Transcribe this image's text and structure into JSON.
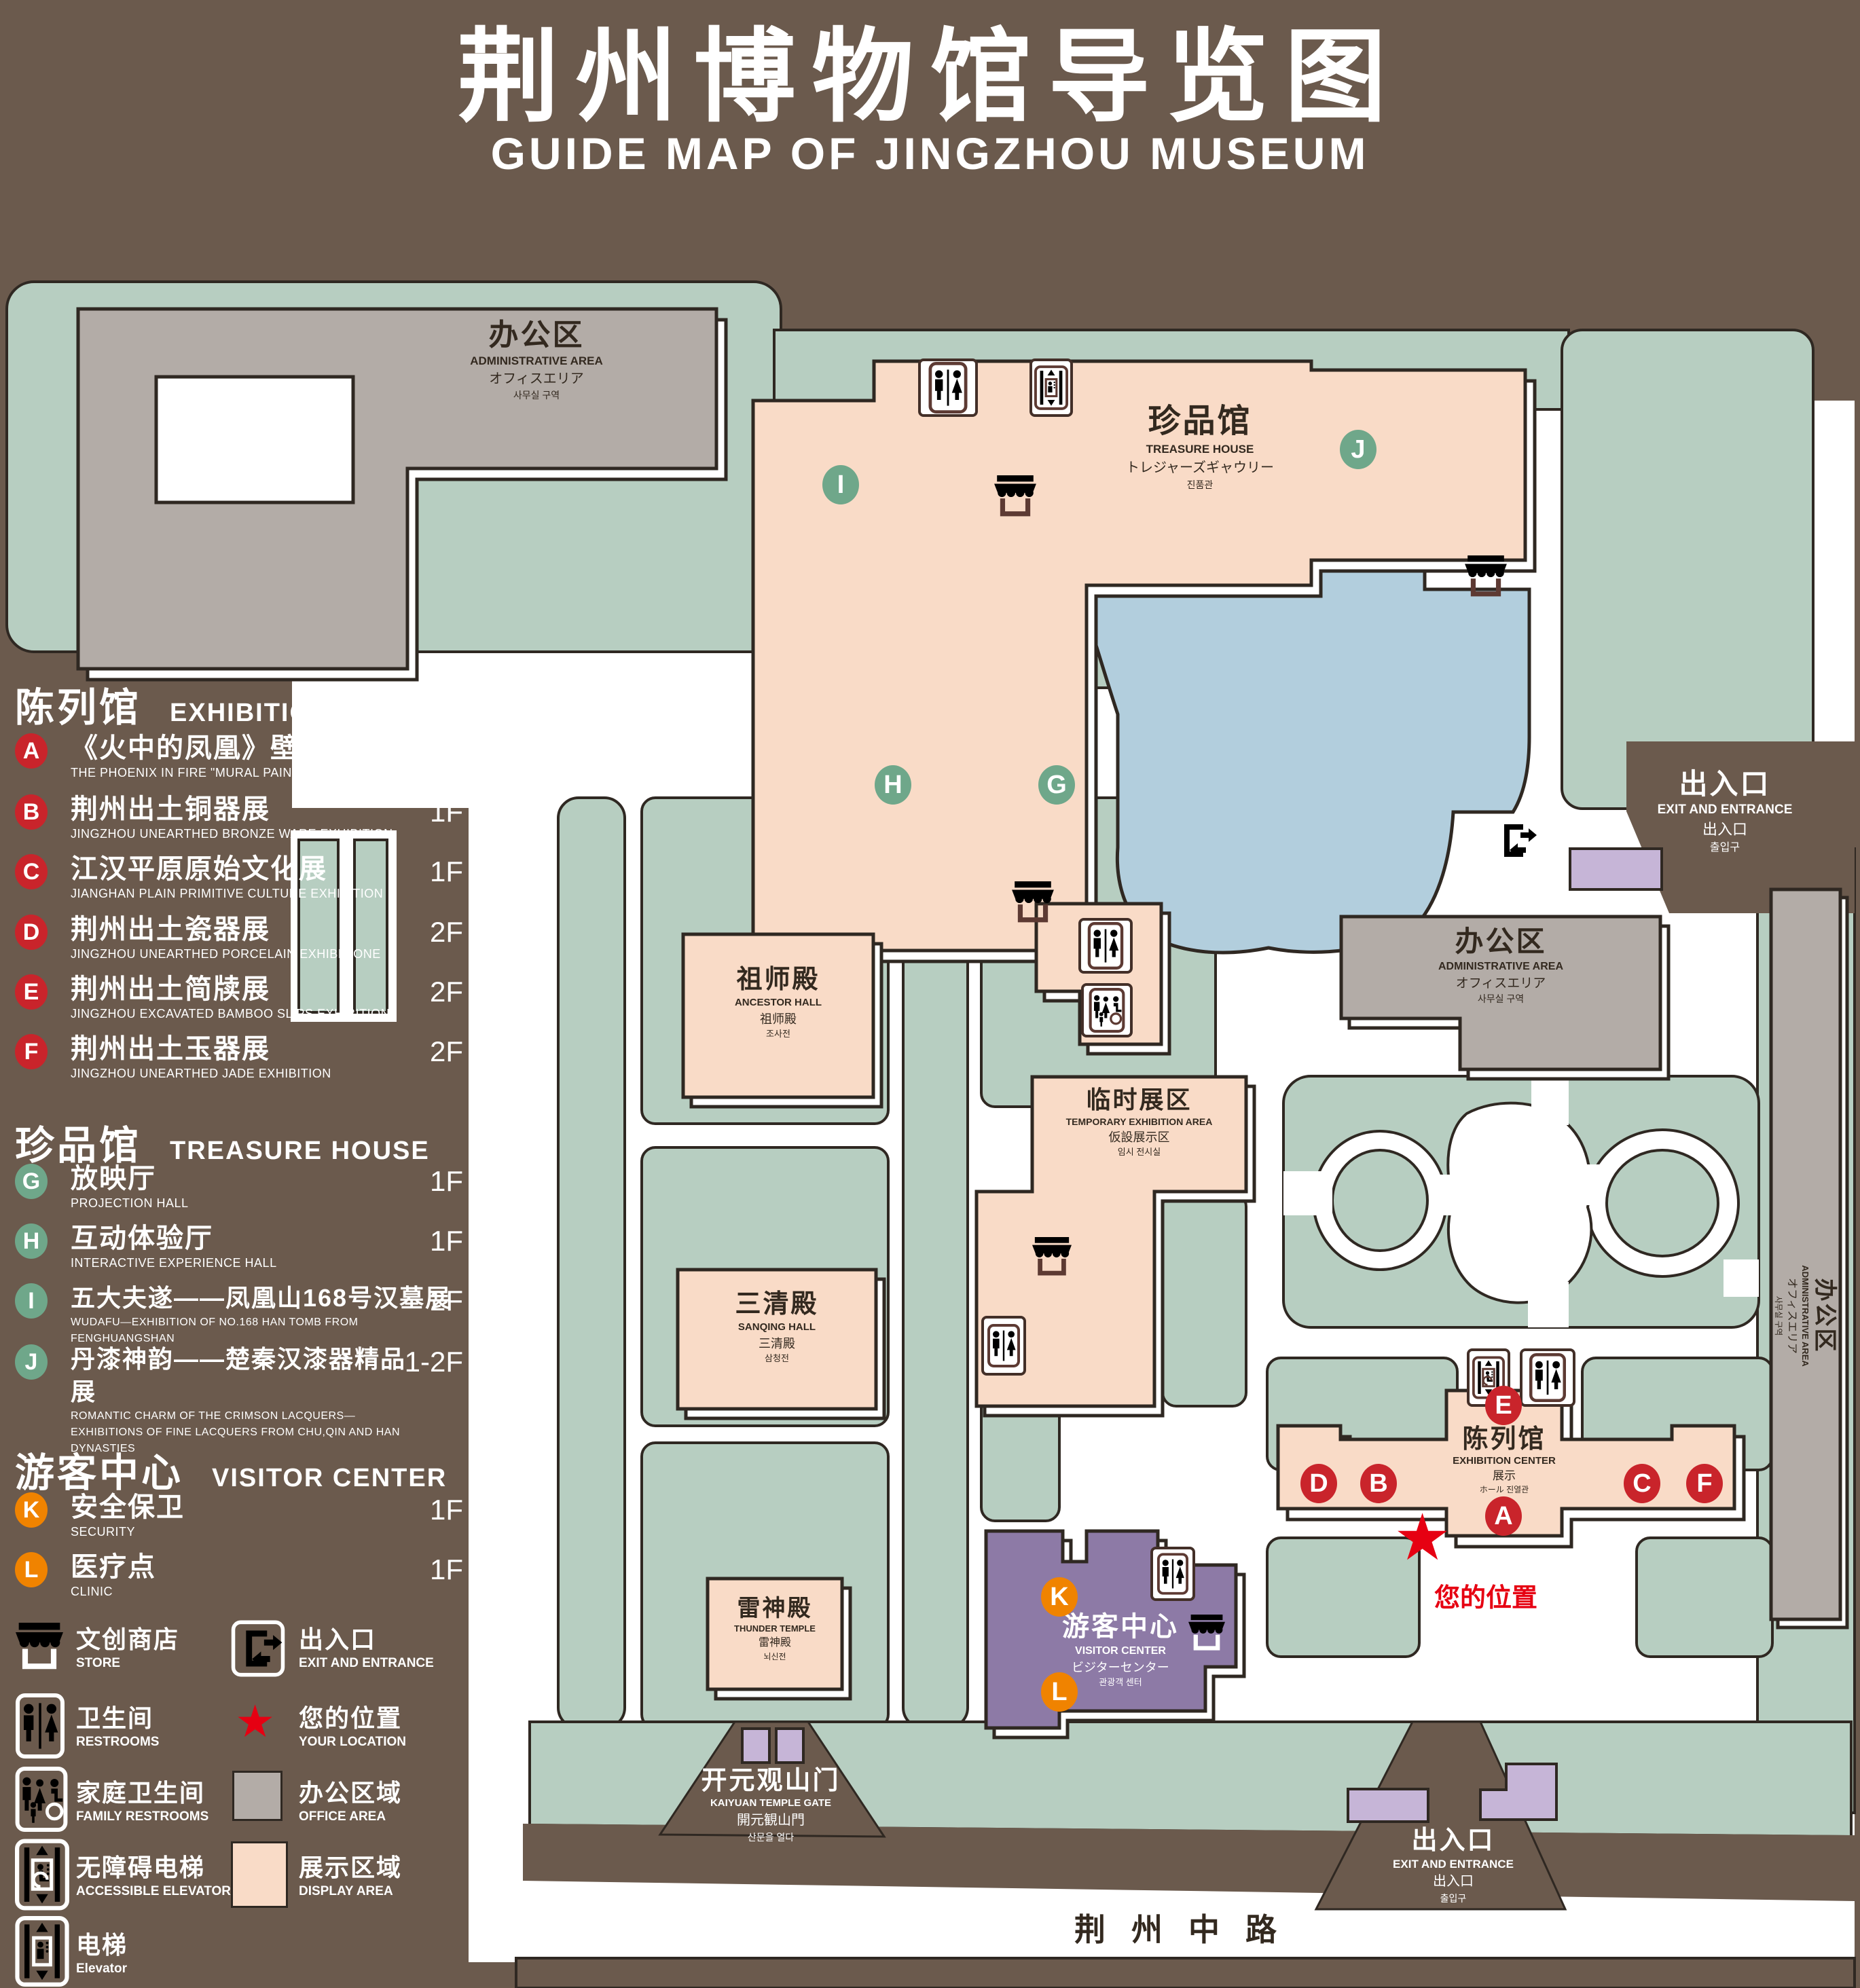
{
  "title": {
    "zh": "荆州博物馆导览图",
    "en": "GUIDE MAP OF JINGZHOU MUSEUM"
  },
  "legend": {
    "sections": [
      {
        "title_zh": "陈列馆",
        "title_en": "EXHIBITION CENTER",
        "items": [
          {
            "id": "A",
            "zh": "《火中的凤凰》壁画",
            "en": "THE PHOENIX IN FIRE \"MURAL PAINTING",
            "floor": "1F"
          },
          {
            "id": "B",
            "zh": "荆州出土铜器展",
            "en": "JINGZHOU UNEARTHED BRONZE WARE EXHIBITION",
            "floor": "1F"
          },
          {
            "id": "C",
            "zh": "江汉平原原始文化展",
            "en": "JIANGHAN PLAIN PRIMITIVE CULTURE EXHIBITION",
            "floor": "1F"
          },
          {
            "id": "D",
            "zh": "荆州出土瓷器展",
            "en": "JINGZHOU UNEARTHED PORCELAIN EXHIBITIONE",
            "floor": "2F"
          },
          {
            "id": "E",
            "zh": "荆州出土简牍展",
            "en": "JINGZHOU EXCAVATED BAMBOO SLIPS EXHIBITION",
            "floor": "2F"
          },
          {
            "id": "F",
            "zh": "荆州出土玉器展",
            "en": "JINGZHOU UNEARTHED JADE EXHIBITION",
            "floor": "2F"
          }
        ]
      },
      {
        "title_zh": "珍品馆",
        "title_en": "TREASURE HOUSE",
        "items": [
          {
            "id": "G",
            "zh": "放映厅",
            "en": "PROJECTION HALL",
            "floor": "1F"
          },
          {
            "id": "H",
            "zh": "互动体验厅",
            "en": "INTERACTIVE EXPERIENCE HALL",
            "floor": "1F"
          },
          {
            "id": "I",
            "zh": "五大夫遂——凤凰山168号汉墓展",
            "en": "WUDAFU—EXHIBITION OF NO.168 HAN TOMB FROM FENGHUANGSHAN",
            "floor": "2F"
          },
          {
            "id": "J",
            "zh": "丹漆神韵——楚秦汉漆器精品展",
            "en": "ROMANTIC CHARM OF THE CRIMSON LACQUERS—EXHIBITIONS OF FINE LACQUERS FROM CHU,QIN AND HAN DYNASTIES",
            "floor": "1-2F"
          }
        ]
      },
      {
        "title_zh": "游客中心",
        "title_en": "VISITOR CENTER",
        "items": [
          {
            "id": "K",
            "zh": "安全保卫",
            "en": "SECURITY",
            "floor": "1F"
          },
          {
            "id": "L",
            "zh": "医疗点",
            "en": "CLINIC",
            "floor": "1F"
          }
        ]
      }
    ],
    "symbols": [
      {
        "icon": "store-icon",
        "zh": "文创商店",
        "en": "STORE"
      },
      {
        "icon": "exit-icon",
        "zh": "出入口",
        "en": "EXIT AND ENTRANCE"
      },
      {
        "icon": "restroom-icon",
        "zh": "卫生间",
        "en": "RESTROOMS"
      },
      {
        "icon": "location-star-icon",
        "zh": "您的位置",
        "en": "YOUR LOCATION"
      },
      {
        "icon": "family-restroom-icon",
        "zh": "家庭卫生间",
        "en": "FAMILY RESTROOMS"
      },
      {
        "icon": "office-area-swatch",
        "zh": "办公区域",
        "en": "OFFICE AREA"
      },
      {
        "icon": "accessible-elevator-icon",
        "zh": "无障碍电梯",
        "en": "ACCESSIBLE ELEVATOR"
      },
      {
        "icon": "display-area-swatch",
        "zh": "展示区域",
        "en": "DISPLAY AREA"
      },
      {
        "icon": "elevator-icon",
        "zh": "电梯",
        "en": "Elevator"
      }
    ]
  },
  "map": {
    "buildings": {
      "admin": {
        "zh": "办公区",
        "en": "ADMINISTRATIVE AREA",
        "ja": "オフィスエリア",
        "ko": "사무실 구역"
      },
      "treasure": {
        "zh": "珍品馆",
        "en": "TREASURE HOUSE",
        "ja": "トレジャーズギャウリー",
        "ko": "진품관"
      },
      "ancestor": {
        "zh": "祖师殿",
        "en": "ANCESTOR HALL",
        "ja": "祖师殿",
        "ko": "조사전"
      },
      "temporary": {
        "zh": "临时展区",
        "en": "TEMPORARY EXHIBITION AREA",
        "ja": "仮設展示区",
        "ko": "임시 전시실"
      },
      "sanqing": {
        "zh": "三清殿",
        "en": "SANQING HALL",
        "ja": "三清殿",
        "ko": "삼청전"
      },
      "thunder": {
        "zh": "雷神殿",
        "en": "THUNDER TEMPLE",
        "ja": "雷神殿",
        "ko": "뇌신전"
      },
      "visitor": {
        "zh": "游客中心",
        "en": "VISITOR CENTER",
        "ja": "ビジターセンター",
        "ko": "관광객 센터"
      },
      "exhibition": {
        "zh": "陈列馆",
        "en": "EXHIBITION CENTER",
        "ja": "展示",
        "ko": "ホール 진열관"
      },
      "gate": {
        "zh": "开元观山门",
        "en": "KAIYUAN TEMPLE GATE",
        "ja": "開元観山門",
        "ko": "산문을 열다"
      }
    },
    "exit": {
      "zh": "出入口",
      "en": "EXIT AND ENTRANCE",
      "ja": "出入口",
      "ko": "출입구"
    },
    "your_location": "您的位置",
    "road": "荆州中路"
  },
  "colors": {
    "background_brown": "#6b5a4d",
    "lawn_green": "#b7cec1",
    "display_area_pink": "#f9dbc7",
    "office_gray": "#b3aca7",
    "pond_blue": "#b2cedd",
    "visitor_purple": "#8d7aa6",
    "gate_purple": "#c6b5d7",
    "badge_red": "#c9242b",
    "badge_green": "#6fa78a",
    "badge_orange": "#f08300",
    "location_red": "#e60012"
  }
}
